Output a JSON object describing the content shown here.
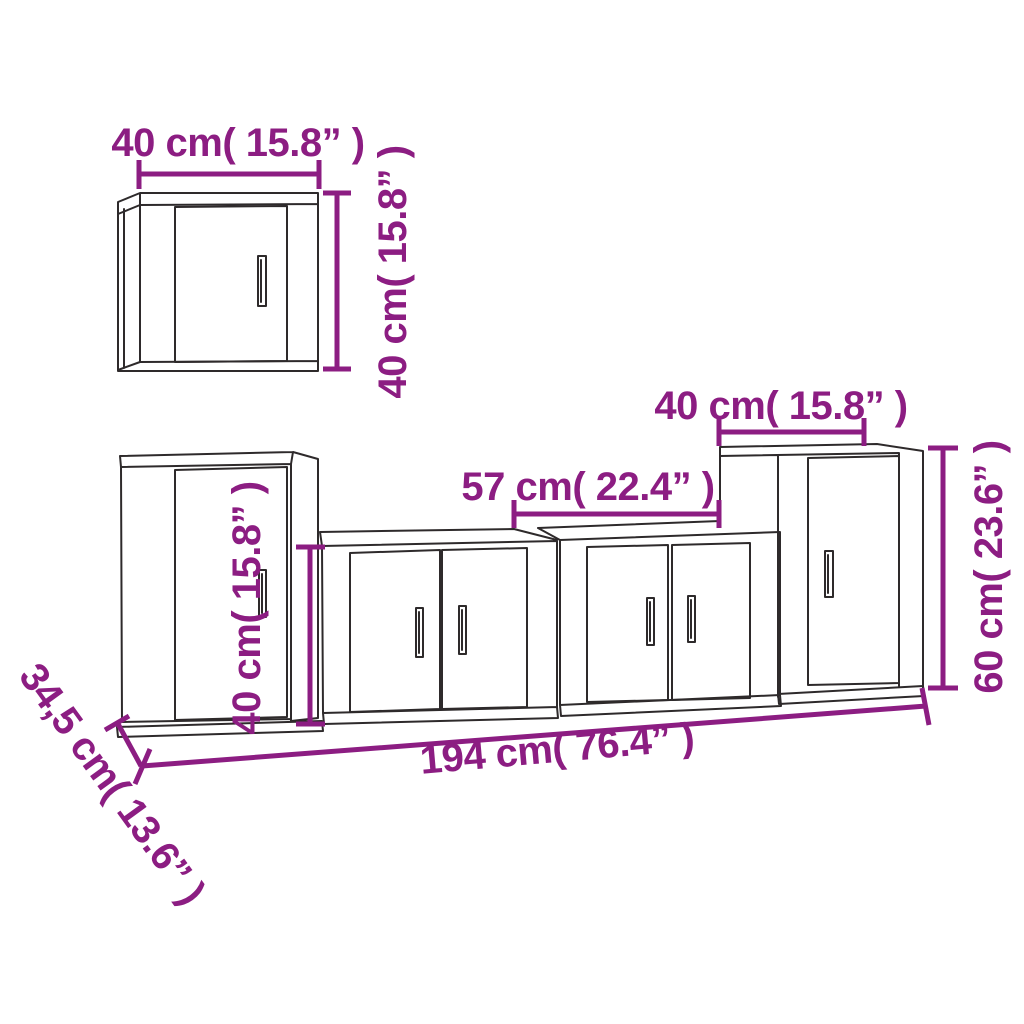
{
  "colors": {
    "accent": "#8C1D82",
    "ink": "#2E2A2B",
    "background": "#FFFFFF"
  },
  "diagram": {
    "kind": "furniture-dimension-diagram",
    "labels": {
      "wall_cabinet": {
        "width": "40 cm( 15.8” )",
        "height": "40 cm( 15.8” )"
      },
      "bench": {
        "width": "57 cm( 22.4” )",
        "height": "40 cm( 15.8” )"
      },
      "side_cabinet": {
        "width": "40 cm( 15.8” )",
        "height": "60 cm( 23.6” )"
      },
      "overall": {
        "total_width": "194 cm( 76.4” )",
        "depth": "34,5 cm( 13.6” )"
      }
    }
  }
}
